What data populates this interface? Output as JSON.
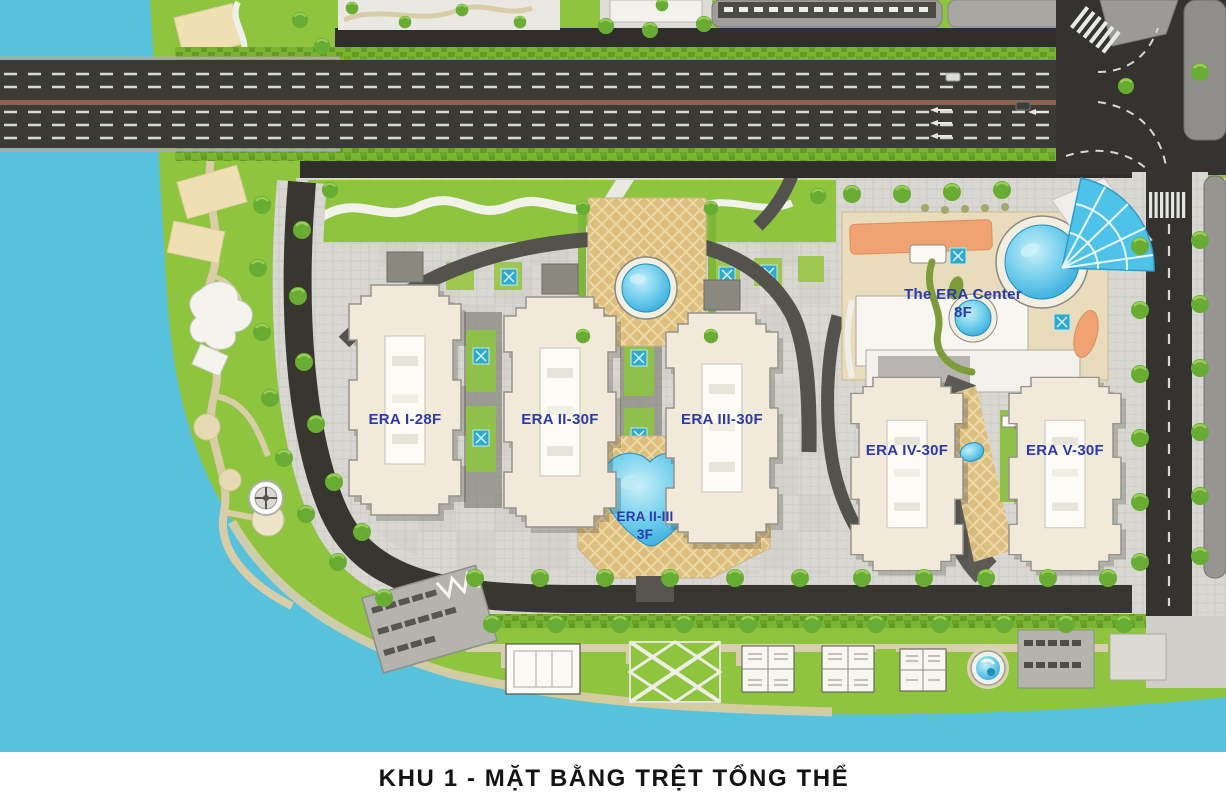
{
  "title": "KHU 1 - MẶT BẰNG TRỆT TỔNG THỂ",
  "buildings": {
    "era1": {
      "label": "ERA I-28F"
    },
    "era2": {
      "label": "ERA II-30F"
    },
    "era3": {
      "label": "ERA III-30F"
    },
    "era4": {
      "label": "ERA IV-30F"
    },
    "era5": {
      "label": "ERA V-30F"
    },
    "center": {
      "name": "The ERA Center",
      "floors": "8F"
    },
    "podium": {
      "name": "ERA II-III",
      "floors": "3F"
    }
  },
  "colors": {
    "water": "#58C2DC",
    "park_green": "#8FC43F",
    "label_blue": "#2A3AA8",
    "road_dark": "#3B3A35",
    "median_brown": "#8B6152",
    "deck_tan": "#DDBE7E",
    "pool_blue": "#3FB4DE",
    "accent_orange": "#F0A273",
    "building_cream": "#F1EADA",
    "title_color": "#141414"
  }
}
